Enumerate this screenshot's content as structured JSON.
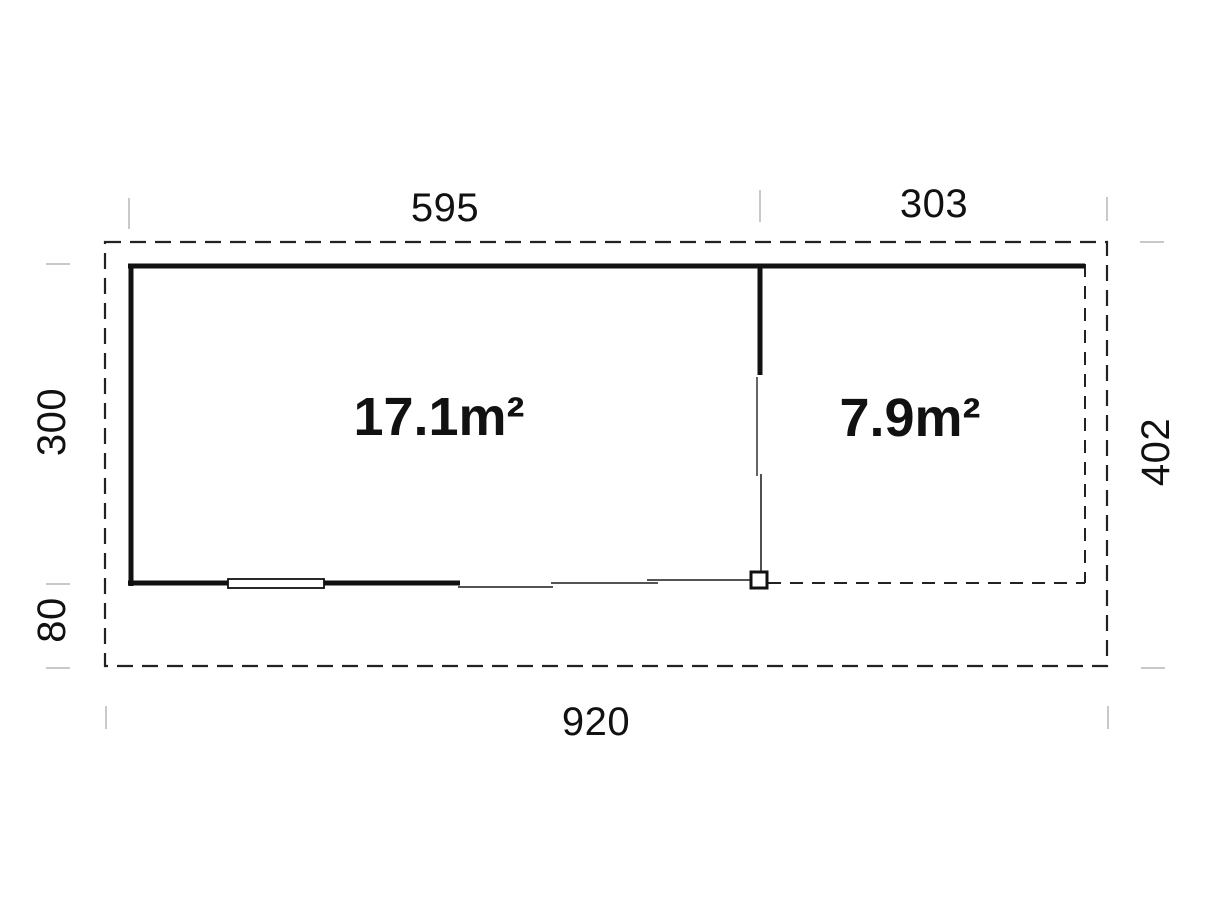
{
  "diagram": {
    "type": "floor-plan",
    "rooms": [
      {
        "id": "main-room",
        "area_label": "17.1m²"
      },
      {
        "id": "terrace",
        "area_label": "7.9m²"
      }
    ],
    "dimensions": {
      "top_left": "595",
      "top_right": "303",
      "left_upper": "300",
      "left_lower": "80",
      "right_side": "402",
      "bottom": "920"
    },
    "colors": {
      "wall_line": "#111111",
      "thin_line": "#3c3c3c",
      "dashed_line": "#222222",
      "tick_mark": "#c9c9c9",
      "background": "#ffffff"
    },
    "symbols": [
      {
        "id": "window-symbol",
        "meaning": "window in bottom wall"
      },
      {
        "id": "sliding-door-panels",
        "meaning": "glazed sliding door front"
      },
      {
        "id": "corner-post",
        "meaning": "terrace corner post"
      },
      {
        "id": "outer-dashed-boundary",
        "meaning": "roof overhang outline"
      }
    ]
  }
}
